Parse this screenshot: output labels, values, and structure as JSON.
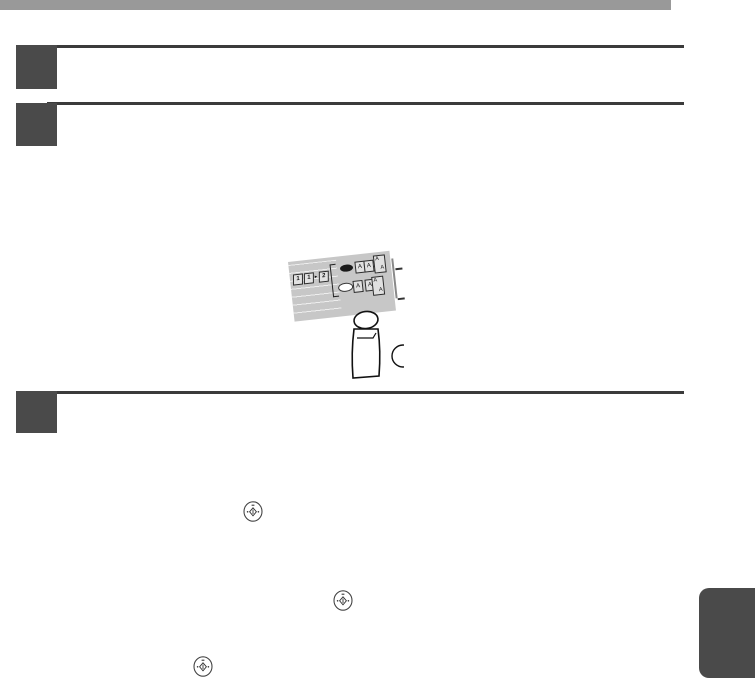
{
  "page": {
    "background": "#ffffff"
  },
  "header": {
    "bar_color": "#999999"
  },
  "steps": {
    "rule_color": "#3b3b3b",
    "box_color": "#4a4a4a",
    "items": [
      {
        "label": ""
      },
      {
        "label": ""
      },
      {
        "label": ""
      }
    ]
  },
  "illustration": {
    "panel_color": "#c7c7c7",
    "duplex": {
      "p1": "1",
      "p2": "1",
      "arrow": "▸",
      "p3": "2"
    },
    "rows": [
      {
        "led": "on",
        "pair": [
          "A",
          "A"
        ],
        "stacked": [
          "A",
          "A"
        ]
      },
      {
        "led": "off",
        "pair": [
          "A",
          "A"
        ],
        "stacked": [
          "A",
          "A"
        ]
      }
    ]
  },
  "icons": {
    "start_key_name": "start-key-icon",
    "start_key_color": "#444444"
  },
  "side_tab": {
    "color": "#4a4a4a"
  }
}
